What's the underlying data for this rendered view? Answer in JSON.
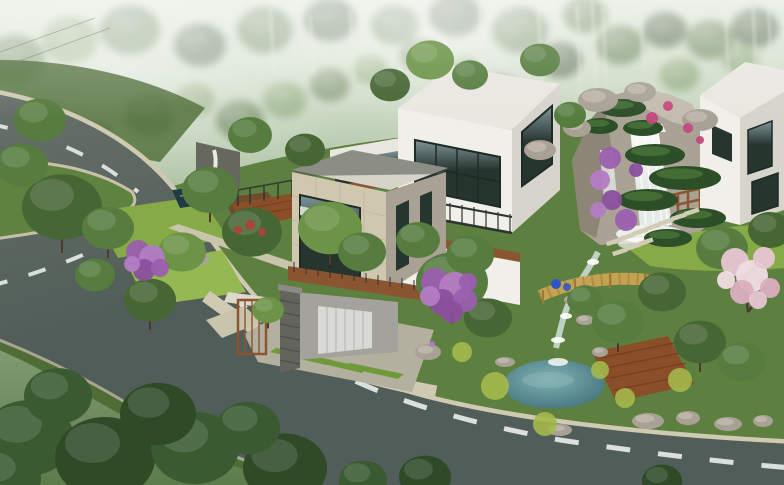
{
  "scene": {
    "kind": "architectural-aerial-rendering",
    "palette": {
      "sky_top": "#cfdcc6",
      "sky_mid": "#9fb894",
      "forest_deep": "#47603c",
      "forest_mid": "#5d7c4c",
      "forest_light": "#7d9c66",
      "haze": "#e8efe4",
      "road": "#515d58",
      "road_light": "#67716a",
      "curb": "#cfcab1",
      "curb_dark": "#b2ad97",
      "dash": "#e8ece8",
      "grass_island": "#5f8240",
      "garden_base": "#5d8040",
      "garden_dark": "#4e6c36",
      "lawn": "#86aa46",
      "lawn_light": "#95b852",
      "grass_strip": "#6f9a3a",
      "soil": "#6e4c2e",
      "pavement": "#c9c4ac",
      "paver": "#d2ccb6",
      "tree_dark": "#33502a",
      "tree_middark": "#466634",
      "tree_mid": "#567d3f",
      "tree_light": "#6b9447",
      "tree_bright": "#7fa855",
      "fg_tree": "#3a5a31",
      "fg_tree_dark": "#2e4a27",
      "topiary": "#2d4f28",
      "topiary_light": "#4e7a3c",
      "trunk": "#4a3a2b",
      "rock_light": "#c6bfb0",
      "rock": "#aaa294",
      "rock_dark": "#837c6d",
      "boulder": "#a8a296",
      "water_white": "#f2f6f2",
      "pond_center": "#7fb2b4",
      "pond_edge": "#3f6d77",
      "pool_dark": "#1f3c44",
      "pool_reflect": "#8fb6b8",
      "stream": "#cfe0da",
      "purple": "#9a5fae",
      "purple_light": "#b37cc4",
      "purple_dark": "#8a4f9e",
      "magenta": "#c4487e",
      "pink": "#e7c6d2",
      "pink_light": "#f0dde4",
      "pink_dark": "#dbaec0",
      "yellow_green": "#a3b94a",
      "red_flower": "#b04038",
      "white_wall": "#f0efe9",
      "white_wall_shade": "#d6d4cb",
      "roof": "#e9e7e0",
      "roof_beige": "#d6d4c9",
      "beige_wall": "#cfc7ae",
      "beige_wall_shade": "#a9a294",
      "glass": "#27352f",
      "glass_light": "#7f9598",
      "frame": "#1e2a26",
      "wood": "#8a5530",
      "wood_dark": "#6b3a1c",
      "deck": "#8a4e28",
      "lattice": "#c8a352",
      "lattice_dark": "#9a7a34",
      "stone_pillar": "#63655c",
      "stone_wall": "#66685e",
      "garage_wall": "#a3a29c",
      "garage_door": "#d9d9d5",
      "door_line": "#b9b9b5",
      "rail": "#2d3330",
      "blue": "#2f55c4",
      "mist": "#ffffff",
      "branch": "#4a3a30"
    },
    "background_trees": [
      {
        "x": 150,
        "y": 115,
        "r": 26,
        "c": "forest_mid"
      },
      {
        "x": 195,
        "y": 100,
        "r": 20,
        "c": "forest_light"
      },
      {
        "x": 240,
        "y": 120,
        "r": 24,
        "c": "forest_mid"
      },
      {
        "x": 285,
        "y": 100,
        "r": 22,
        "c": "forest_light"
      },
      {
        "x": 330,
        "y": 85,
        "r": 20,
        "c": "forest_mid"
      },
      {
        "x": 370,
        "y": 70,
        "r": 18,
        "c": "forest_light"
      },
      {
        "x": 420,
        "y": 55,
        "r": 20,
        "c": "forest_mid"
      },
      {
        "x": 465,
        "y": 70,
        "r": 16,
        "c": "forest_light"
      },
      {
        "x": 90,
        "y": 140,
        "r": 24,
        "c": "forest_mid"
      },
      {
        "x": 45,
        "y": 120,
        "r": 22,
        "c": "forest_light"
      },
      {
        "x": 15,
        "y": 60,
        "r": 30,
        "c": "forest_mid"
      },
      {
        "x": 70,
        "y": 40,
        "r": 28,
        "c": "forest_light"
      },
      {
        "x": 130,
        "y": 30,
        "r": 30,
        "c": "forest_mid"
      },
      {
        "x": 200,
        "y": 45,
        "r": 26,
        "c": "forest_deep"
      },
      {
        "x": 265,
        "y": 30,
        "r": 28,
        "c": "forest_mid"
      },
      {
        "x": 330,
        "y": 20,
        "r": 26,
        "c": "forest_deep"
      },
      {
        "x": 395,
        "y": 25,
        "r": 24,
        "c": "forest_mid"
      },
      {
        "x": 455,
        "y": 15,
        "r": 26,
        "c": "forest_deep"
      },
      {
        "x": 520,
        "y": 30,
        "r": 28,
        "c": "forest_mid"
      },
      {
        "x": 560,
        "y": 60,
        "r": 22,
        "c": "forest_deep"
      },
      {
        "x": 620,
        "y": 45,
        "r": 24,
        "c": "forest_mid"
      },
      {
        "x": 665,
        "y": 30,
        "r": 22,
        "c": "forest_deep"
      },
      {
        "x": 710,
        "y": 40,
        "r": 24,
        "c": "forest_mid"
      },
      {
        "x": 755,
        "y": 28,
        "r": 24,
        "c": "forest_deep"
      },
      {
        "x": 585,
        "y": 15,
        "r": 22,
        "c": "forest_mid"
      },
      {
        "x": 680,
        "y": 75,
        "r": 20,
        "c": "forest_light"
      },
      {
        "x": 740,
        "y": 60,
        "r": 18,
        "c": "forest_light"
      },
      {
        "x": 500,
        "y": 90,
        "r": 18,
        "c": "forest_deep"
      },
      {
        "x": 540,
        "y": 105,
        "r": 16,
        "c": "forest_mid"
      }
    ],
    "birches": [
      {
        "x": 538,
        "y1": 0,
        "y2": 100
      },
      {
        "x": 577,
        "y1": 5,
        "y2": 105
      },
      {
        "x": 592,
        "y1": 0,
        "y2": 95
      },
      {
        "x": 603,
        "y1": 8,
        "y2": 110
      },
      {
        "x": 725,
        "y1": 0,
        "y2": 90
      },
      {
        "x": 753,
        "y1": 5,
        "y2": 100
      },
      {
        "x": 768,
        "y1": 0,
        "y2": 85
      },
      {
        "x": 350,
        "y1": 10,
        "y2": 80
      },
      {
        "x": 310,
        "y1": 15,
        "y2": 75
      },
      {
        "x": 270,
        "y1": 8,
        "y2": 70
      },
      {
        "x": 480,
        "y1": 5,
        "y2": 85
      },
      {
        "x": 640,
        "y1": 0,
        "y2": 70
      }
    ],
    "garden_trees": [
      {
        "x": 62,
        "y": 207,
        "r": 40,
        "c": "tree_middark",
        "t": 1
      },
      {
        "x": 22,
        "y": 165,
        "r": 26,
        "c": "tree_mid"
      },
      {
        "x": 108,
        "y": 228,
        "r": 26,
        "c": "tree_mid",
        "t": 1
      },
      {
        "x": 210,
        "y": 190,
        "r": 28,
        "c": "tree_mid",
        "t": 1
      },
      {
        "x": 252,
        "y": 232,
        "r": 30,
        "c": "tree_middark"
      },
      {
        "x": 182,
        "y": 252,
        "r": 24,
        "c": "tree_light"
      },
      {
        "x": 150,
        "y": 300,
        "r": 26,
        "c": "tree_middark",
        "t": 1
      },
      {
        "x": 95,
        "y": 275,
        "r": 20,
        "c": "tree_mid"
      },
      {
        "x": 330,
        "y": 228,
        "r": 32,
        "c": "tree_light",
        "t": 1
      },
      {
        "x": 362,
        "y": 252,
        "r": 24,
        "c": "tree_mid"
      },
      {
        "x": 268,
        "y": 310,
        "r": 16,
        "c": "tree_light",
        "t": 1
      },
      {
        "x": 452,
        "y": 282,
        "r": 36,
        "c": "tree_mid",
        "t": 1
      },
      {
        "x": 488,
        "y": 318,
        "r": 24,
        "c": "tree_middark"
      },
      {
        "x": 418,
        "y": 240,
        "r": 22,
        "c": "tree_mid"
      },
      {
        "x": 470,
        "y": 255,
        "r": 24,
        "c": "tree_mid"
      },
      {
        "x": 585,
        "y": 300,
        "r": 18,
        "c": "tree_mid"
      },
      {
        "x": 618,
        "y": 322,
        "r": 26,
        "c": "tree_mid",
        "t": 1
      },
      {
        "x": 662,
        "y": 292,
        "r": 24,
        "c": "tree_middark"
      },
      {
        "x": 700,
        "y": 342,
        "r": 26,
        "c": "tree_middark",
        "t": 1
      },
      {
        "x": 742,
        "y": 362,
        "r": 24,
        "c": "tree_mid"
      },
      {
        "x": 722,
        "y": 248,
        "r": 26,
        "c": "tree_mid"
      },
      {
        "x": 770,
        "y": 230,
        "r": 22,
        "c": "tree_middark"
      },
      {
        "x": 540,
        "y": 60,
        "r": 20,
        "c": "tree_mid"
      },
      {
        "x": 430,
        "y": 60,
        "r": 24,
        "c": "tree_light"
      },
      {
        "x": 390,
        "y": 85,
        "r": 20,
        "c": "tree_middark"
      },
      {
        "x": 470,
        "y": 75,
        "r": 18,
        "c": "tree_mid"
      },
      {
        "x": 570,
        "y": 115,
        "r": 16,
        "c": "tree_mid"
      },
      {
        "x": 40,
        "y": 120,
        "r": 26,
        "c": "tree_mid"
      },
      {
        "x": 250,
        "y": 135,
        "r": 22,
        "c": "tree_mid"
      },
      {
        "x": 305,
        "y": 150,
        "r": 20,
        "c": "tree_middark"
      }
    ],
    "foreground_trees": [
      {
        "x": 28,
        "y": 438,
        "r": 46,
        "c": "fg_tree"
      },
      {
        "x": 105,
        "y": 458,
        "r": 50,
        "c": "fg_tree_dark"
      },
      {
        "x": 195,
        "y": 448,
        "r": 44,
        "c": "fg_tree"
      },
      {
        "x": 285,
        "y": 468,
        "r": 42,
        "c": "fg_tree_dark"
      },
      {
        "x": 58,
        "y": 396,
        "r": 34,
        "c": "fg_tree"
      },
      {
        "x": 158,
        "y": 414,
        "r": 38,
        "c": "fg_tree_dark"
      },
      {
        "x": 248,
        "y": 428,
        "r": 32,
        "c": "fg_tree"
      },
      {
        "x": 5,
        "y": 478,
        "r": 36,
        "c": "fg_tree"
      },
      {
        "x": 425,
        "y": 477,
        "r": 26,
        "c": "fg_tree_dark"
      },
      {
        "x": 662,
        "y": 481,
        "r": 20,
        "c": "fg_tree_dark"
      },
      {
        "x": 363,
        "y": 480,
        "r": 24,
        "c": "fg_tree"
      }
    ],
    "topiary_pads": [
      {
        "x": 655,
        "y": 155,
        "rx": 30,
        "ry": 11
      },
      {
        "x": 685,
        "y": 178,
        "rx": 36,
        "ry": 12
      },
      {
        "x": 648,
        "y": 200,
        "rx": 30,
        "ry": 11
      },
      {
        "x": 698,
        "y": 218,
        "rx": 28,
        "ry": 10
      },
      {
        "x": 668,
        "y": 238,
        "rx": 24,
        "ry": 9
      },
      {
        "x": 622,
        "y": 108,
        "rx": 24,
        "ry": 9
      },
      {
        "x": 600,
        "y": 126,
        "rx": 18,
        "ry": 8
      },
      {
        "x": 643,
        "y": 128,
        "rx": 20,
        "ry": 8
      }
    ],
    "purple_blossoms": [
      {
        "x": 435,
        "y": 282,
        "r": 14,
        "c": "purple"
      },
      {
        "x": 455,
        "y": 288,
        "r": 16,
        "c": "purple_light"
      },
      {
        "x": 442,
        "y": 302,
        "r": 13,
        "c": "purple_dark"
      },
      {
        "x": 465,
        "y": 300,
        "r": 12,
        "c": "purple"
      },
      {
        "x": 430,
        "y": 296,
        "r": 10,
        "c": "purple_light"
      },
      {
        "x": 452,
        "y": 312,
        "r": 11,
        "c": "purple_dark"
      },
      {
        "x": 468,
        "y": 282,
        "r": 9,
        "c": "purple"
      },
      {
        "x": 138,
        "y": 252,
        "r": 12,
        "c": "purple"
      },
      {
        "x": 152,
        "y": 258,
        "r": 13,
        "c": "purple_light"
      },
      {
        "x": 144,
        "y": 270,
        "r": 11,
        "c": "purple_dark"
      },
      {
        "x": 160,
        "y": 268,
        "r": 9,
        "c": "purple"
      },
      {
        "x": 132,
        "y": 264,
        "r": 8,
        "c": "purple_light"
      },
      {
        "x": 610,
        "y": 158,
        "r": 11,
        "c": "purple"
      },
      {
        "x": 600,
        "y": 180,
        "r": 10,
        "c": "purple_light"
      },
      {
        "x": 612,
        "y": 200,
        "r": 10,
        "c": "purple_dark"
      },
      {
        "x": 626,
        "y": 220,
        "r": 11,
        "c": "purple"
      },
      {
        "x": 598,
        "y": 210,
        "r": 8,
        "c": "purple_light"
      },
      {
        "x": 636,
        "y": 170,
        "r": 7,
        "c": "purple_dark"
      },
      {
        "x": 652,
        "y": 118,
        "r": 6,
        "c": "magenta"
      },
      {
        "x": 668,
        "y": 106,
        "r": 5,
        "c": "magenta"
      },
      {
        "x": 688,
        "y": 128,
        "r": 5,
        "c": "magenta"
      },
      {
        "x": 700,
        "y": 140,
        "r": 4,
        "c": "magenta"
      }
    ],
    "pink_blossoms": [
      {
        "x": 735,
        "y": 262,
        "r": 14,
        "c": "pink"
      },
      {
        "x": 752,
        "y": 276,
        "r": 16,
        "c": "pink_light"
      },
      {
        "x": 742,
        "y": 292,
        "r": 12,
        "c": "pink_dark"
      },
      {
        "x": 764,
        "y": 258,
        "r": 11,
        "c": "pink"
      },
      {
        "x": 770,
        "y": 288,
        "r": 10,
        "c": "pink_dark"
      },
      {
        "x": 726,
        "y": 280,
        "r": 9,
        "c": "pink_light"
      },
      {
        "x": 758,
        "y": 300,
        "r": 9,
        "c": "pink"
      }
    ],
    "flower_accents": [
      {
        "x": 495,
        "y": 386,
        "r": 14,
        "c": "yellow_green"
      },
      {
        "x": 545,
        "y": 424,
        "r": 12,
        "c": "yellow_green"
      },
      {
        "x": 625,
        "y": 398,
        "r": 10,
        "c": "yellow_green"
      },
      {
        "x": 680,
        "y": 380,
        "r": 12,
        "c": "yellow_green"
      },
      {
        "x": 600,
        "y": 370,
        "r": 9,
        "c": "yellow_green"
      },
      {
        "x": 462,
        "y": 352,
        "r": 10,
        "c": "yellow_green"
      },
      {
        "x": 250,
        "y": 225,
        "r": 5,
        "c": "red_flower"
      },
      {
        "x": 262,
        "y": 232,
        "r": 4,
        "c": "red_flower"
      },
      {
        "x": 238,
        "y": 230,
        "r": 4,
        "c": "red_flower"
      },
      {
        "x": 432,
        "y": 344,
        "r": 3,
        "c": "purple_light"
      }
    ],
    "boulders": [
      {
        "x": 648,
        "y": 421,
        "rx": 16,
        "ry": 8
      },
      {
        "x": 688,
        "y": 418,
        "rx": 12,
        "ry": 7
      },
      {
        "x": 728,
        "y": 424,
        "rx": 14,
        "ry": 7
      },
      {
        "x": 763,
        "y": 421,
        "rx": 10,
        "ry": 6
      },
      {
        "x": 560,
        "y": 430,
        "rx": 12,
        "ry": 6
      },
      {
        "x": 505,
        "y": 362,
        "rx": 10,
        "ry": 5
      },
      {
        "x": 600,
        "y": 352,
        "rx": 8,
        "ry": 5
      },
      {
        "x": 572,
        "y": 300,
        "rx": 8,
        "ry": 5
      },
      {
        "x": 585,
        "y": 320,
        "rx": 9,
        "ry": 5
      },
      {
        "x": 195,
        "y": 258,
        "rx": 14,
        "ry": 9
      },
      {
        "x": 598,
        "y": 100,
        "rx": 20,
        "ry": 12
      },
      {
        "x": 640,
        "y": 92,
        "rx": 16,
        "ry": 10
      },
      {
        "x": 577,
        "y": 128,
        "rx": 14,
        "ry": 9
      },
      {
        "x": 700,
        "y": 120,
        "rx": 18,
        "ry": 11
      },
      {
        "x": 428,
        "y": 352,
        "rx": 13,
        "ry": 8
      },
      {
        "x": 540,
        "y": 150,
        "rx": 16,
        "ry": 10
      }
    ],
    "stone_pavers": [
      {
        "x": 606,
        "y": 242
      },
      {
        "x": 619,
        "y": 237
      },
      {
        "x": 632,
        "y": 232
      },
      {
        "x": 645,
        "y": 227
      },
      {
        "x": 658,
        "y": 222
      },
      {
        "x": 671,
        "y": 217
      },
      {
        "x": 684,
        "y": 212
      },
      {
        "x": 612,
        "y": 252
      },
      {
        "x": 625,
        "y": 247
      },
      {
        "x": 638,
        "y": 242
      }
    ]
  }
}
